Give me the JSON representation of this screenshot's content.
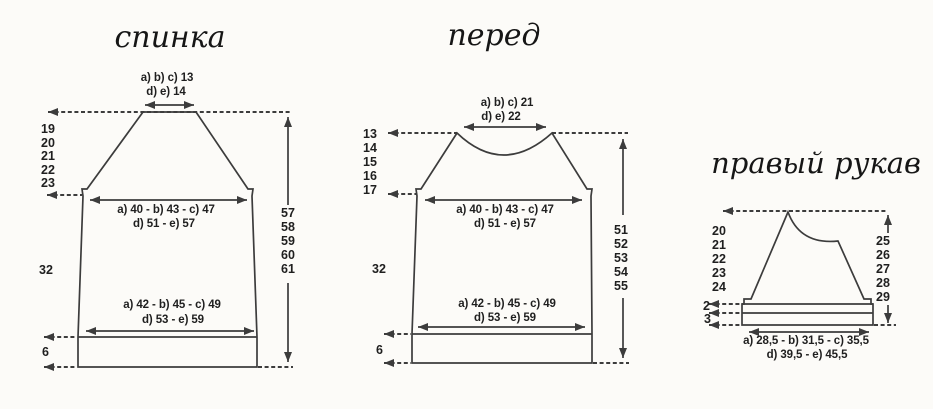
{
  "colors": {
    "background": "#fcfbf8",
    "line_ink": "#3c3c3c",
    "text_ink": "#1f1f1f"
  },
  "back": {
    "title": "спинка",
    "shoulder_width_abc": "a) b) c) 13",
    "shoulder_width_de": "d) e) 14",
    "armhole_depths": [
      "19",
      "20",
      "21",
      "22",
      "23"
    ],
    "chest_width_abc": "a) 40 - b) 43 - c) 47",
    "chest_width_de": "d) 51 - e) 57",
    "side_length": "32",
    "hem_width_abc": "a) 42 - b) 45 - c) 49",
    "hem_width_de": "d) 53 - e) 59",
    "rib_height": "6",
    "total_lengths": [
      "57",
      "58",
      "59",
      "60",
      "61"
    ]
  },
  "front": {
    "title": "перед",
    "neck_width_abc": "a) b) c) 21",
    "neck_width_de": "d) e) 22",
    "raglan_depths": [
      "13",
      "14",
      "15",
      "16",
      "17"
    ],
    "chest_width_abc": "a) 40 - b) 43 - c) 47",
    "chest_width_de": "d) 51 - e) 57",
    "side_length": "32",
    "hem_width_abc": "a) 42 - b) 45 - c) 49",
    "hem_width_de": "d) 53 - e) 59",
    "rib_height": "6",
    "total_lengths": [
      "51",
      "52",
      "53",
      "54",
      "55"
    ]
  },
  "sleeve": {
    "title": "правый рукав",
    "cap_depths": [
      "20",
      "21",
      "22",
      "23",
      "24"
    ],
    "lower_band_height": "2",
    "cuff_band_height": "3",
    "upper_lengths": [
      "25",
      "26",
      "27",
      "28",
      "29"
    ],
    "cuff_width_abc": "a) 28,5 - b) 31,5 - c) 35,5",
    "cuff_width_de": "d) 39,5 - e) 45,5"
  }
}
